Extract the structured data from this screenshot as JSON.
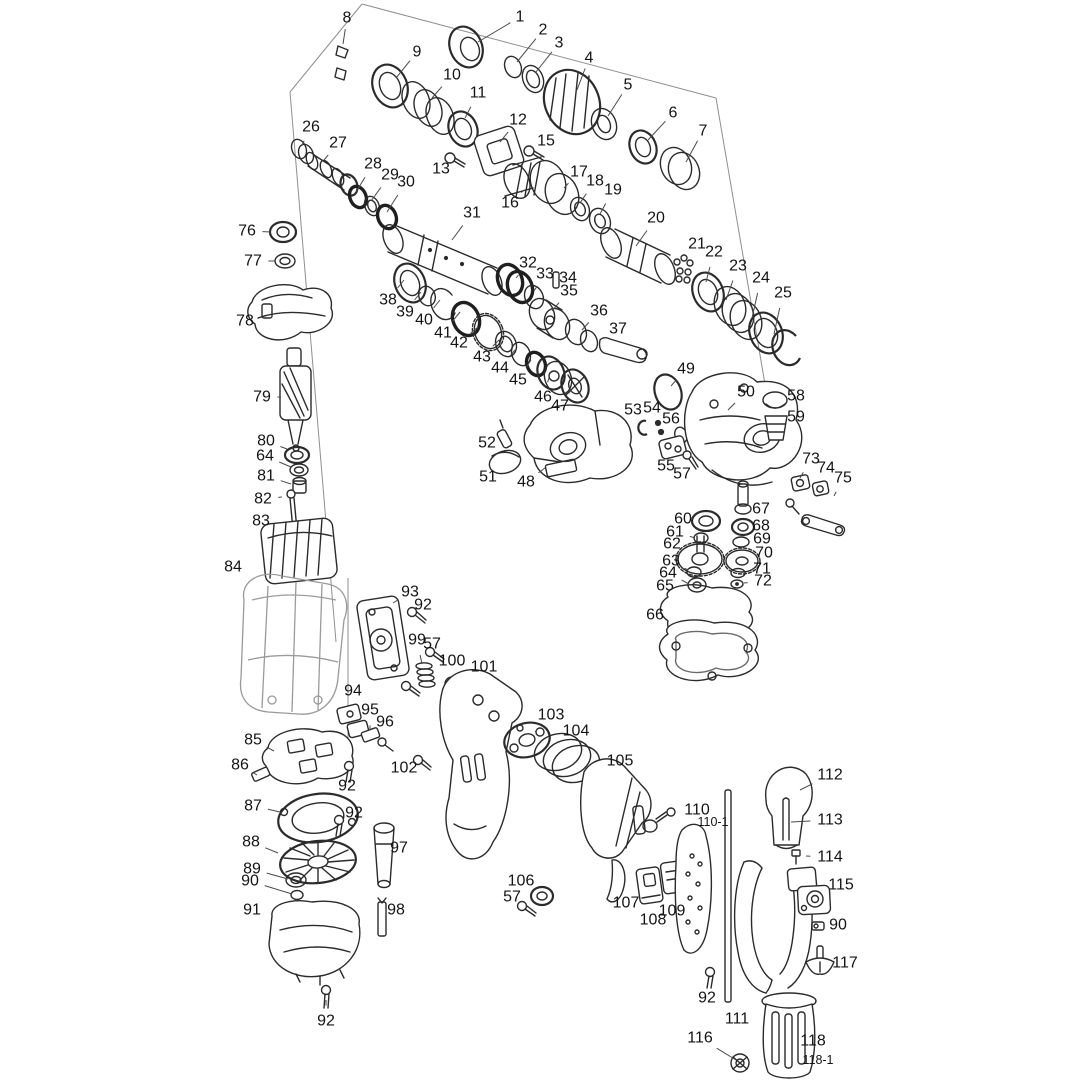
{
  "diagram": {
    "type": "exploded-parts-diagram",
    "subject": "rotary hammer drill",
    "background": "#ffffff",
    "line_color": "#2b2b2b",
    "label_color": "#141414",
    "leader_color": "#4a4a4a"
  },
  "labels": [
    {
      "t": "1",
      "x": 520,
      "y": 17,
      "lx": 478,
      "ly": 42
    },
    {
      "t": "2",
      "x": 543,
      "y": 30,
      "lx": 517,
      "ly": 62
    },
    {
      "t": "3",
      "x": 559,
      "y": 43,
      "lx": 536,
      "ly": 72
    },
    {
      "t": "4",
      "x": 589,
      "y": 58,
      "lx": 577,
      "ly": 90
    },
    {
      "t": "5",
      "x": 628,
      "y": 85,
      "lx": 608,
      "ly": 116
    },
    {
      "t": "6",
      "x": 673,
      "y": 113,
      "lx": 648,
      "ly": 140
    },
    {
      "t": "7",
      "x": 703,
      "y": 131,
      "lx": 686,
      "ly": 162
    },
    {
      "t": "8",
      "x": 347,
      "y": 18,
      "lx": 343,
      "ly": 44
    },
    {
      "t": "9",
      "x": 417,
      "y": 52,
      "lx": 396,
      "ly": 78
    },
    {
      "t": "10",
      "x": 452,
      "y": 75,
      "lx": 432,
      "ly": 98
    },
    {
      "t": "11",
      "x": 478,
      "y": 93,
      "lx": 465,
      "ly": 118
    },
    {
      "t": "12",
      "x": 518,
      "y": 120,
      "lx": 500,
      "ly": 142
    },
    {
      "t": "13",
      "x": 441,
      "y": 169,
      "lx": 452,
      "ly": 162
    },
    {
      "t": "15",
      "x": 546,
      "y": 141,
      "lx": 536,
      "ly": 152
    },
    {
      "t": "16",
      "x": 510,
      "y": 203,
      "lx": 524,
      "ly": 190
    },
    {
      "t": "17",
      "x": 579,
      "y": 172,
      "lx": 564,
      "ly": 188
    },
    {
      "t": "18",
      "x": 595,
      "y": 181,
      "lx": 580,
      "ly": 203
    },
    {
      "t": "19",
      "x": 613,
      "y": 190,
      "lx": 600,
      "ly": 214
    },
    {
      "t": "20",
      "x": 656,
      "y": 218,
      "lx": 636,
      "ly": 246
    },
    {
      "t": "21",
      "x": 697,
      "y": 244,
      "lx": 687,
      "ly": 258
    },
    {
      "t": "22",
      "x": 714,
      "y": 252,
      "lx": 706,
      "ly": 282
    },
    {
      "t": "23",
      "x": 738,
      "y": 266,
      "lx": 726,
      "ly": 300
    },
    {
      "t": "24",
      "x": 761,
      "y": 278,
      "lx": 752,
      "ly": 318
    },
    {
      "t": "25",
      "x": 783,
      "y": 293,
      "lx": 774,
      "ly": 334
    },
    {
      "t": "26",
      "x": 311,
      "y": 127,
      "lx": 302,
      "ly": 145
    },
    {
      "t": "27",
      "x": 338,
      "y": 143,
      "lx": 324,
      "ly": 160
    },
    {
      "t": "28",
      "x": 373,
      "y": 164,
      "lx": 356,
      "ly": 192
    },
    {
      "t": "29",
      "x": 390,
      "y": 175,
      "lx": 371,
      "ly": 201
    },
    {
      "t": "30",
      "x": 406,
      "y": 182,
      "lx": 387,
      "ly": 212
    },
    {
      "t": "31",
      "x": 472,
      "y": 213,
      "lx": 452,
      "ly": 240
    },
    {
      "t": "32",
      "x": 528,
      "y": 263,
      "lx": 516,
      "ly": 278
    },
    {
      "t": "33",
      "x": 545,
      "y": 274,
      "lx": 534,
      "ly": 291
    },
    {
      "t": "34",
      "x": 568,
      "y": 278,
      "lx": 557,
      "ly": 286
    },
    {
      "t": "35",
      "x": 569,
      "y": 291,
      "lx": 552,
      "ly": 311
    },
    {
      "t": "36",
      "x": 599,
      "y": 311,
      "lx": 582,
      "ly": 330
    },
    {
      "t": "37",
      "x": 618,
      "y": 329,
      "lx": 612,
      "ly": 342
    },
    {
      "t": "38",
      "x": 388,
      "y": 300,
      "lx": 404,
      "ly": 280
    },
    {
      "t": "39",
      "x": 405,
      "y": 312,
      "lx": 421,
      "ly": 292
    },
    {
      "t": "40",
      "x": 424,
      "y": 320,
      "lx": 440,
      "ly": 300
    },
    {
      "t": "41",
      "x": 443,
      "y": 333,
      "lx": 460,
      "ly": 312
    },
    {
      "t": "42",
      "x": 459,
      "y": 343,
      "lx": 478,
      "ly": 327
    },
    {
      "t": "43",
      "x": 482,
      "y": 357,
      "lx": 499,
      "ly": 340
    },
    {
      "t": "44",
      "x": 500,
      "y": 368,
      "lx": 515,
      "ly": 350
    },
    {
      "t": "45",
      "x": 518,
      "y": 380,
      "lx": 531,
      "ly": 360
    },
    {
      "t": "46",
      "x": 543,
      "y": 397,
      "lx": 549,
      "ly": 378
    },
    {
      "t": "47",
      "x": 560,
      "y": 406,
      "lx": 571,
      "ly": 390
    },
    {
      "t": "48",
      "x": 526,
      "y": 482,
      "lx": 545,
      "ly": 468
    },
    {
      "t": "49",
      "x": 686,
      "y": 369,
      "lx": 671,
      "ly": 386
    },
    {
      "t": "50",
      "x": 746,
      "y": 392,
      "lx": 728,
      "ly": 410
    },
    {
      "t": "51",
      "x": 488,
      "y": 477,
      "lx": 501,
      "ly": 464
    },
    {
      "t": "52",
      "x": 487,
      "y": 443,
      "lx": 500,
      "ly": 440
    },
    {
      "t": "53",
      "x": 633,
      "y": 410,
      "lx": 643,
      "ly": 424
    },
    {
      "t": "54",
      "x": 652,
      "y": 408,
      "lx": 656,
      "ly": 421
    },
    {
      "t": "55",
      "x": 666,
      "y": 466,
      "lx": 671,
      "ly": 450
    },
    {
      "t": "56",
      "x": 671,
      "y": 419,
      "lx": 679,
      "ly": 433
    },
    {
      "t": "57",
      "x": 682,
      "y": 474,
      "lx": 687,
      "ly": 458
    },
    {
      "t": "58",
      "x": 796,
      "y": 396,
      "lx": 781,
      "ly": 402
    },
    {
      "t": "59",
      "x": 796,
      "y": 417,
      "lx": 780,
      "ly": 423
    },
    {
      "t": "60",
      "x": 683,
      "y": 519,
      "lx": 697,
      "ly": 522
    },
    {
      "t": "61",
      "x": 675,
      "y": 532,
      "lx": 695,
      "ly": 538
    },
    {
      "t": "62",
      "x": 672,
      "y": 544,
      "lx": 686,
      "ly": 553
    },
    {
      "t": "63",
      "x": 671,
      "y": 561,
      "lx": 688,
      "ly": 570
    },
    {
      "t": "64",
      "x": 668,
      "y": 573,
      "lx": 689,
      "ly": 584
    },
    {
      "t": "65",
      "x": 665,
      "y": 586,
      "lx": 678,
      "ly": 594
    },
    {
      "t": "66",
      "x": 655,
      "y": 615,
      "lx": 669,
      "ly": 621
    },
    {
      "t": "67",
      "x": 761,
      "y": 509,
      "lx": 748,
      "ly": 506
    },
    {
      "t": "68",
      "x": 761,
      "y": 526,
      "lx": 749,
      "ly": 527
    },
    {
      "t": "69",
      "x": 762,
      "y": 539,
      "lx": 748,
      "ly": 541
    },
    {
      "t": "70",
      "x": 764,
      "y": 553,
      "lx": 752,
      "ly": 558
    },
    {
      "t": "71",
      "x": 762,
      "y": 569,
      "lx": 745,
      "ly": 571
    },
    {
      "t": "72",
      "x": 763,
      "y": 581,
      "lx": 744,
      "ly": 583
    },
    {
      "t": "73",
      "x": 811,
      "y": 459,
      "lx": 800,
      "ly": 478
    },
    {
      "t": "74",
      "x": 826,
      "y": 468,
      "lx": 820,
      "ly": 484
    },
    {
      "t": "75",
      "x": 843,
      "y": 478,
      "lx": 834,
      "ly": 496
    },
    {
      "t": "76",
      "x": 247,
      "y": 231,
      "lx": 271,
      "ly": 232
    },
    {
      "t": "77",
      "x": 253,
      "y": 261,
      "lx": 275,
      "ly": 261
    },
    {
      "t": "78",
      "x": 245,
      "y": 321,
      "lx": 262,
      "ly": 320
    },
    {
      "t": "79",
      "x": 262,
      "y": 397,
      "lx": 281,
      "ly": 397
    },
    {
      "t": "80",
      "x": 266,
      "y": 441,
      "lx": 287,
      "ly": 449
    },
    {
      "t": "64",
      "x": 265,
      "y": 456,
      "lx": 291,
      "ly": 467
    },
    {
      "t": "81",
      "x": 266,
      "y": 476,
      "lx": 291,
      "ly": 484
    },
    {
      "t": "82",
      "x": 263,
      "y": 499,
      "lx": 282,
      "ly": 497
    },
    {
      "t": "83",
      "x": 261,
      "y": 521,
      "lx": 276,
      "ly": 524
    },
    {
      "t": "84",
      "x": 233,
      "y": 567,
      "lx": 249,
      "ly": 576
    },
    {
      "t": "85",
      "x": 253,
      "y": 740,
      "lx": 274,
      "ly": 751
    },
    {
      "t": "86",
      "x": 240,
      "y": 765,
      "lx": 257,
      "ly": 775
    },
    {
      "t": "87",
      "x": 253,
      "y": 806,
      "lx": 280,
      "ly": 812
    },
    {
      "t": "88",
      "x": 251,
      "y": 842,
      "lx": 278,
      "ly": 853
    },
    {
      "t": "89",
      "x": 252,
      "y": 869,
      "lx": 288,
      "ly": 879
    },
    {
      "t": "90",
      "x": 250,
      "y": 881,
      "lx": 292,
      "ly": 894
    },
    {
      "t": "91",
      "x": 252,
      "y": 910,
      "lx": 268,
      "ly": 918
    },
    {
      "t": "92",
      "x": 423,
      "y": 605,
      "lx": 412,
      "ly": 612
    },
    {
      "t": "93",
      "x": 410,
      "y": 592,
      "lx": 393,
      "ly": 603
    },
    {
      "t": "94",
      "x": 353,
      "y": 691,
      "lx": 355,
      "ly": 708
    },
    {
      "t": "95",
      "x": 370,
      "y": 710,
      "lx": 370,
      "ly": 730
    },
    {
      "t": "96",
      "x": 385,
      "y": 722,
      "lx": 384,
      "ly": 740
    },
    {
      "t": "97",
      "x": 399,
      "y": 848,
      "lx": 390,
      "ly": 852
    },
    {
      "t": "98",
      "x": 396,
      "y": 910,
      "lx": 386,
      "ly": 912
    },
    {
      "t": "99",
      "x": 417,
      "y": 640,
      "lx": 422,
      "ly": 664
    },
    {
      "t": "57",
      "x": 432,
      "y": 644,
      "lx": 432,
      "ly": 656
    },
    {
      "t": "100",
      "x": 452,
      "y": 661,
      "lx": 452,
      "ly": 680
    },
    {
      "t": "101",
      "x": 484,
      "y": 667,
      "lx": 477,
      "ly": 684
    },
    {
      "t": "102",
      "x": 404,
      "y": 768,
      "lx": 415,
      "ly": 762
    },
    {
      "t": "103",
      "x": 551,
      "y": 715,
      "lx": 535,
      "ly": 732
    },
    {
      "t": "104",
      "x": 576,
      "y": 731,
      "lx": 563,
      "ly": 746
    },
    {
      "t": "105",
      "x": 620,
      "y": 761,
      "lx": 606,
      "ly": 774
    },
    {
      "t": "106",
      "x": 521,
      "y": 881,
      "lx": 534,
      "ly": 892
    },
    {
      "t": "57",
      "x": 512,
      "y": 897,
      "lx": 523,
      "ly": 905
    },
    {
      "t": "107",
      "x": 626,
      "y": 903,
      "lx": 624,
      "ly": 891
    },
    {
      "t": "108",
      "x": 653,
      "y": 920,
      "lx": 650,
      "ly": 903
    },
    {
      "t": "109",
      "x": 672,
      "y": 911,
      "lx": 671,
      "ly": 895
    },
    {
      "t": "110",
      "x": 697,
      "y": 810,
      "lx": 692,
      "ly": 832
    },
    {
      "t": "110-1",
      "x": 713,
      "y": 822,
      "lx": 701,
      "ly": 845
    },
    {
      "t": "111",
      "x": 737,
      "y": 1019,
      "lx": 729,
      "ly": 1002
    },
    {
      "t": "112",
      "x": 830,
      "y": 775,
      "lx": 800,
      "ly": 790
    },
    {
      "t": "113",
      "x": 830,
      "y": 820,
      "lx": 791,
      "ly": 822
    },
    {
      "t": "114",
      "x": 830,
      "y": 857,
      "lx": 806,
      "ly": 856
    },
    {
      "t": "115",
      "x": 841,
      "y": 885,
      "lx": 826,
      "ly": 892
    },
    {
      "t": "90",
      "x": 838,
      "y": 925,
      "lx": 824,
      "ly": 926
    },
    {
      "t": "117",
      "x": 845,
      "y": 963,
      "lx": 829,
      "ly": 962
    },
    {
      "t": "116",
      "x": 700,
      "y": 1038,
      "lx": 736,
      "ly": 1060
    },
    {
      "t": "118",
      "x": 813,
      "y": 1041,
      "lx": 792,
      "ly": 1042
    },
    {
      "t": "118-1",
      "x": 818,
      "y": 1060,
      "lx": 796,
      "ly": 1058
    },
    {
      "t": "92",
      "x": 347,
      "y": 786,
      "lx": 349,
      "ly": 772
    },
    {
      "t": "92",
      "x": 354,
      "y": 813,
      "lx": 341,
      "ly": 819
    },
    {
      "t": "92",
      "x": 326,
      "y": 1021,
      "lx": 326,
      "ly": 1000
    },
    {
      "t": "92",
      "x": 707,
      "y": 998,
      "lx": 709,
      "ly": 980
    }
  ]
}
